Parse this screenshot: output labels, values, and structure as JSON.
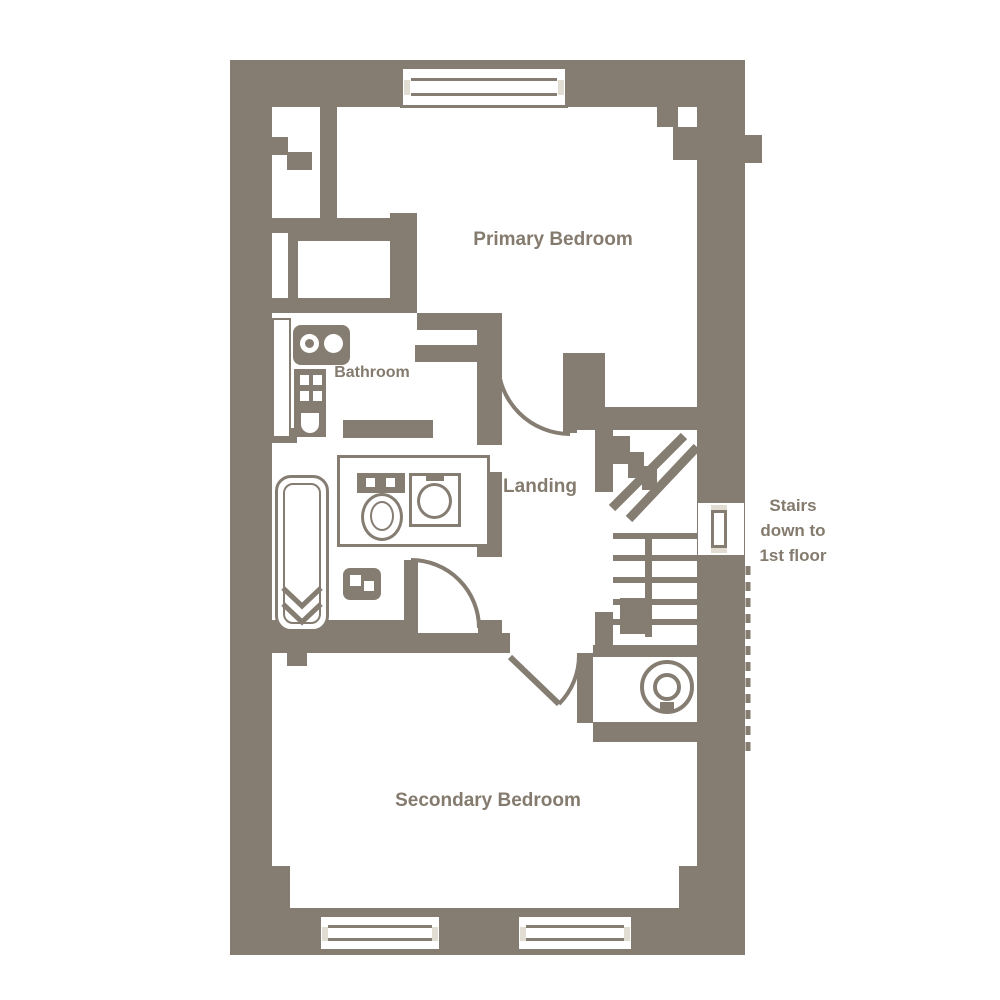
{
  "palette": {
    "wall": "#867D72",
    "label": "#847B6E",
    "window_accent": "#E2DDD2",
    "background": "#FFFFFF"
  },
  "rooms": {
    "primary_bedroom": "Primary Bedroom",
    "bathroom": "Bathroom",
    "landing": "Landing",
    "secondary_bedroom": "Secondary Bedroom"
  },
  "annotation": {
    "line1": "Stairs",
    "line2": "down to",
    "line3": "1st floor"
  },
  "fixtures": {
    "bathtub": "bathtub",
    "toilet": "toilet",
    "wash_basin": "wash-basin",
    "vanity_unit": "vanity-unit",
    "radiator": "radiator",
    "shelf_unit": "shelf-unit",
    "hot_water_cylinder": "hot-water-cylinder",
    "staircase": "staircase",
    "wardrobe": "wardrobe",
    "window": "window",
    "door": "door"
  }
}
